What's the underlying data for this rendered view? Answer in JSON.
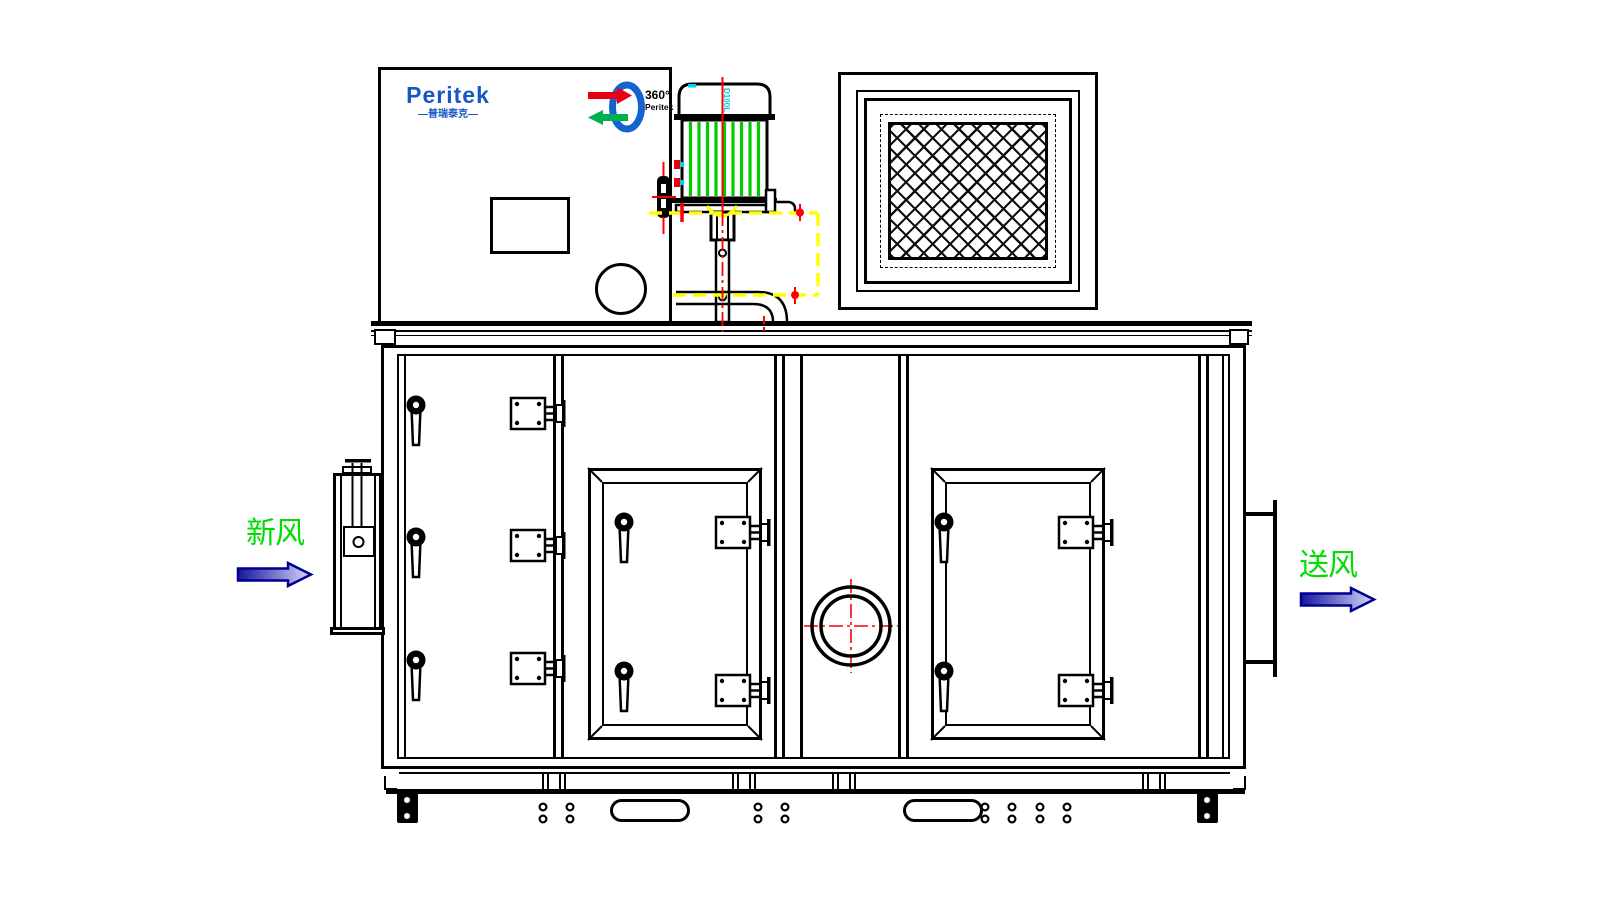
{
  "brand": {
    "name": "Peritek",
    "subtitle_cn": "—普瑞泰克—"
  },
  "ring_logo": {
    "text_degrees": "360°",
    "text_brand": "Peritek"
  },
  "motor": {
    "frame_size_label": "D100L"
  },
  "flow": {
    "inlet_label": "新风",
    "outlet_label": "送风"
  },
  "colors": {
    "outline": "#000000",
    "flow_label_green": "#00dd00",
    "motor_fin_green": "#00cc00",
    "brand_blue": "#1857c4",
    "centerline_red": "#ff0000",
    "datum_yellow": "#ffff00",
    "detail_cyan": "#00c8dc",
    "arrow_fill_dark": "#16159e",
    "arrow_fill_light": "#d8d8fa",
    "logo_red": "#e60012",
    "logo_green": "#00b050"
  }
}
